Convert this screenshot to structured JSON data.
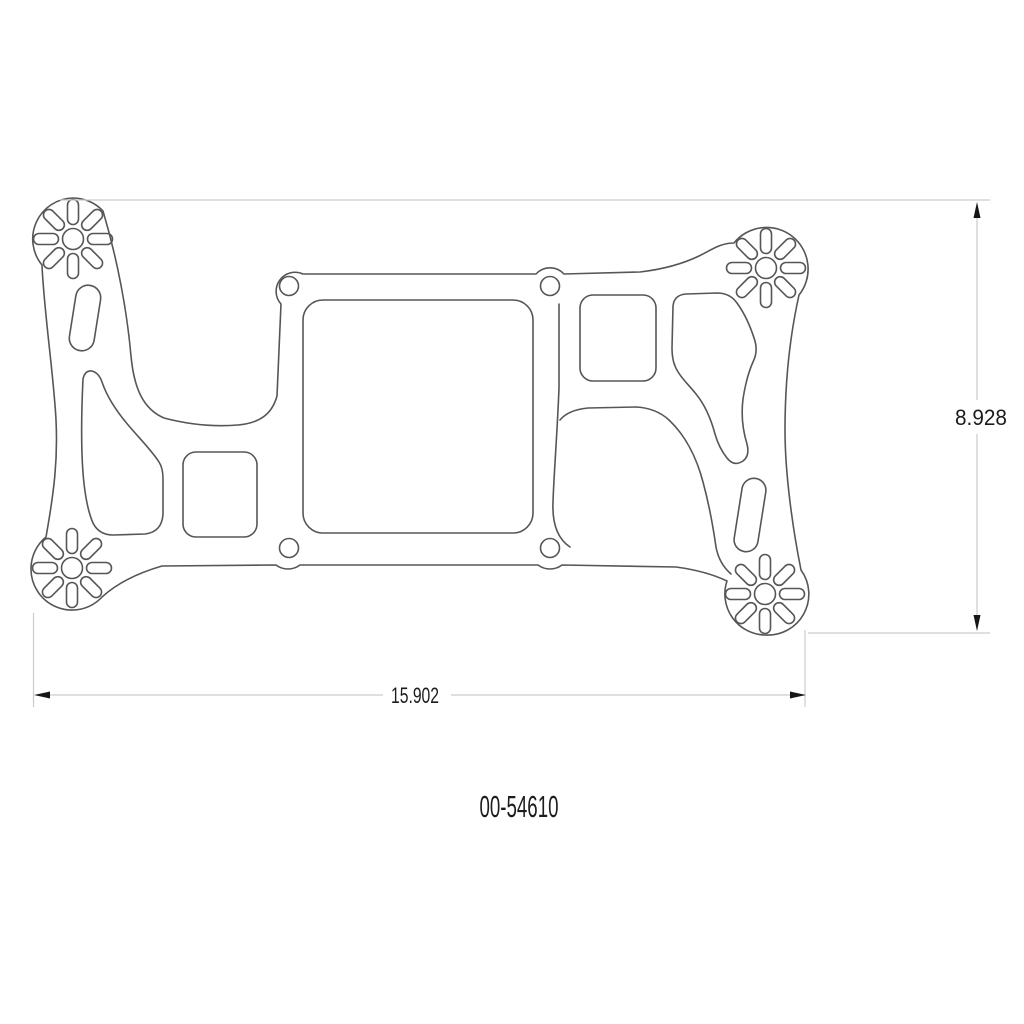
{
  "drawing": {
    "part_number": "00-54610",
    "dimensions": {
      "height": "8.928",
      "width": "15.902"
    },
    "colors": {
      "outline": "#565656",
      "dim_line": "#c9cccb",
      "arrow": "#161616",
      "text": "#1c1c1c"
    }
  }
}
